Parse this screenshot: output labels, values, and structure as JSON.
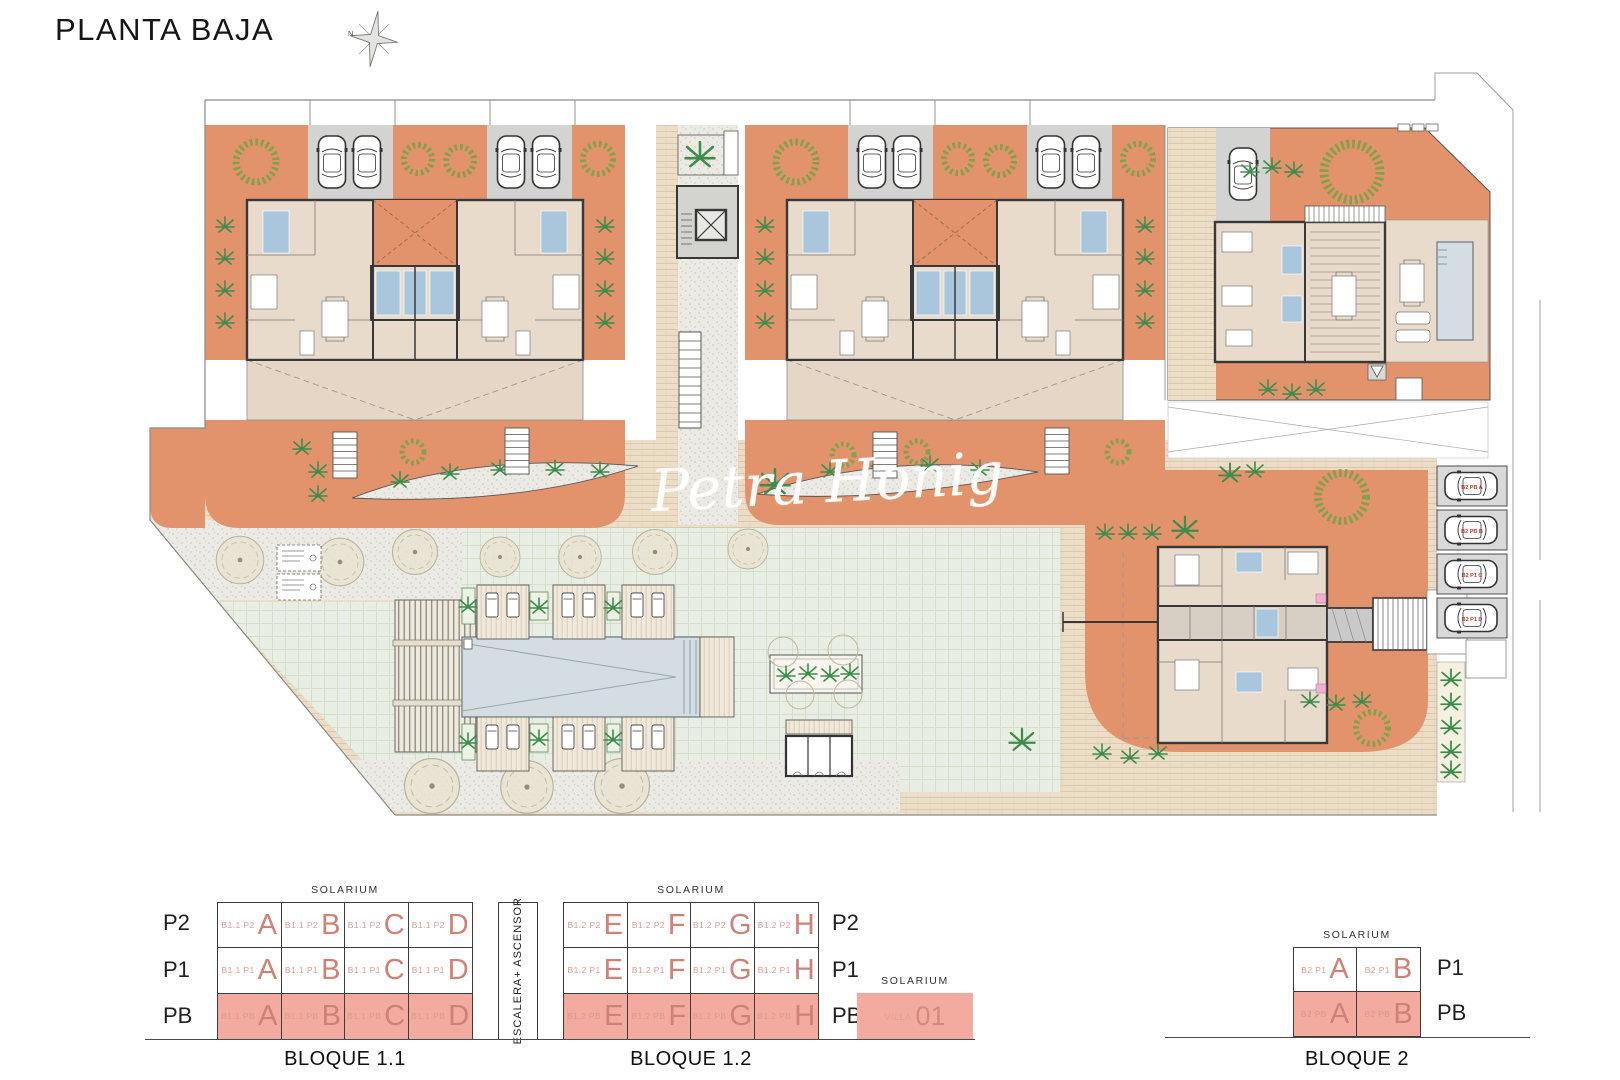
{
  "title": "PLANTA BAJA",
  "compass": {
    "north_label": "N"
  },
  "watermark": "Petra Honig",
  "colors": {
    "terrace_orange": "#e2936c",
    "highlight_pink": "#f3aba0",
    "unit_letter_salmon": "#cf8176",
    "plant_green": "#3c8d4c",
    "pool_blue": "#d4dde2"
  },
  "plan": {
    "parking_labels": [
      "B2 PB A",
      "B2 PB B",
      "B2 P1 C",
      "B2 P1 D"
    ]
  },
  "legend": {
    "solarium_label": "SOLARIUM",
    "escalera_label": "ESCALERA+ ASCENSOR",
    "bloque11": {
      "caption": "BLOQUE 1.1",
      "floor_labels": [
        "P2",
        "P1",
        "PB"
      ],
      "rows": [
        {
          "floor": "P2",
          "cells": [
            {
              "prefix": "B1.1 P2",
              "letter": "A"
            },
            {
              "prefix": "B1.1 P2",
              "letter": "B"
            },
            {
              "prefix": "B1.1 P2",
              "letter": "C"
            },
            {
              "prefix": "B1.1 P2",
              "letter": "D"
            }
          ]
        },
        {
          "floor": "P1",
          "cells": [
            {
              "prefix": "B1.1 P1",
              "letter": "A"
            },
            {
              "prefix": "B1.1 P1",
              "letter": "B"
            },
            {
              "prefix": "B1.1 P1",
              "letter": "C"
            },
            {
              "prefix": "B1.1 P1",
              "letter": "D"
            }
          ]
        },
        {
          "floor": "PB",
          "cells": [
            {
              "prefix": "B1.1 PB",
              "letter": "A"
            },
            {
              "prefix": "B1.1 PB",
              "letter": "B"
            },
            {
              "prefix": "B1.1 PB",
              "letter": "C"
            },
            {
              "prefix": "B1.1 PB",
              "letter": "D"
            }
          ]
        }
      ]
    },
    "bloque12": {
      "caption": "BLOQUE 1.2",
      "floor_labels": [
        "P2",
        "P1",
        "PB"
      ],
      "rows": [
        {
          "floor": "P2",
          "cells": [
            {
              "prefix": "B1.2 P2",
              "letter": "E"
            },
            {
              "prefix": "B1.2 P2",
              "letter": "F"
            },
            {
              "prefix": "B1.2 P2",
              "letter": "G"
            },
            {
              "prefix": "B1.2 P2",
              "letter": "H"
            }
          ]
        },
        {
          "floor": "P1",
          "cells": [
            {
              "prefix": "B1.2 P1",
              "letter": "E"
            },
            {
              "prefix": "B1.2 P1",
              "letter": "F"
            },
            {
              "prefix": "B1.2 P1",
              "letter": "G"
            },
            {
              "prefix": "B1.2 P1",
              "letter": "H"
            }
          ]
        },
        {
          "floor": "PB",
          "cells": [
            {
              "prefix": "B1.2 PB",
              "letter": "E"
            },
            {
              "prefix": "B1.2 PB",
              "letter": "F"
            },
            {
              "prefix": "B1.2 PB",
              "letter": "G"
            },
            {
              "prefix": "B1.2 PB",
              "letter": "H"
            }
          ]
        }
      ]
    },
    "villa": {
      "solarium_label": "SOLARIUM",
      "prefix": "VILLA",
      "number": "01"
    },
    "bloque2": {
      "caption": "BLOQUE 2",
      "floor_labels": [
        "P1",
        "PB"
      ],
      "rows": [
        {
          "floor": "P1",
          "cells": [
            {
              "prefix": "B2 P1",
              "letter": "A"
            },
            {
              "prefix": "B2 P1",
              "letter": "B"
            }
          ]
        },
        {
          "floor": "PB",
          "cells": [
            {
              "prefix": "B2 PB",
              "letter": "A"
            },
            {
              "prefix": "B2 PB",
              "letter": "B"
            }
          ]
        }
      ]
    }
  }
}
